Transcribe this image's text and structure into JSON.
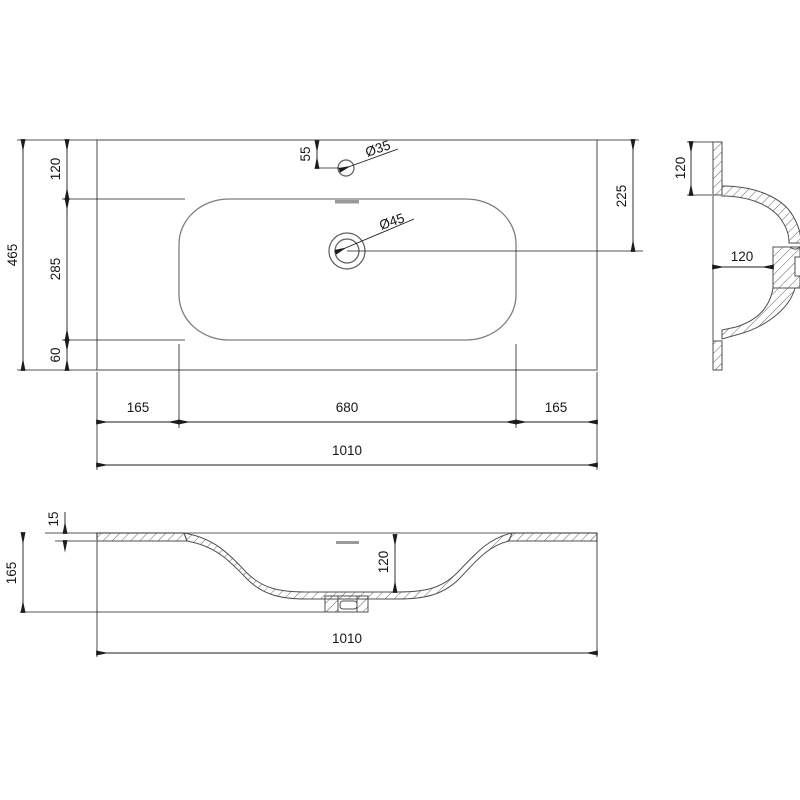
{
  "title": "Washbasin technical drawing",
  "colors": {
    "background": "#ffffff",
    "outline_gray": "#949494",
    "basin_gray": "#7e7e7e",
    "section_line": "#4f4f4f",
    "dimension_black": "#1c1c1c"
  },
  "plan_view": {
    "overall_width": "1010",
    "overall_depth": "465",
    "back_to_bowl": "120",
    "bowl_depth": "285",
    "bowl_to_front": "60",
    "bowl_left_offset": "165",
    "bowl_width": "680",
    "bowl_right_offset": "165",
    "faucet_from_back": "55",
    "faucet_hole_diameter": "Ø35",
    "drain_hole_diameter": "Ø45",
    "drain_from_back": "225"
  },
  "side_view": {
    "rim_from_top": "120",
    "bowl_depth": "120"
  },
  "front_view": {
    "top_thickness": "15",
    "overall_height": "165",
    "bowl_inner_depth": "120",
    "overall_width": "1010"
  }
}
